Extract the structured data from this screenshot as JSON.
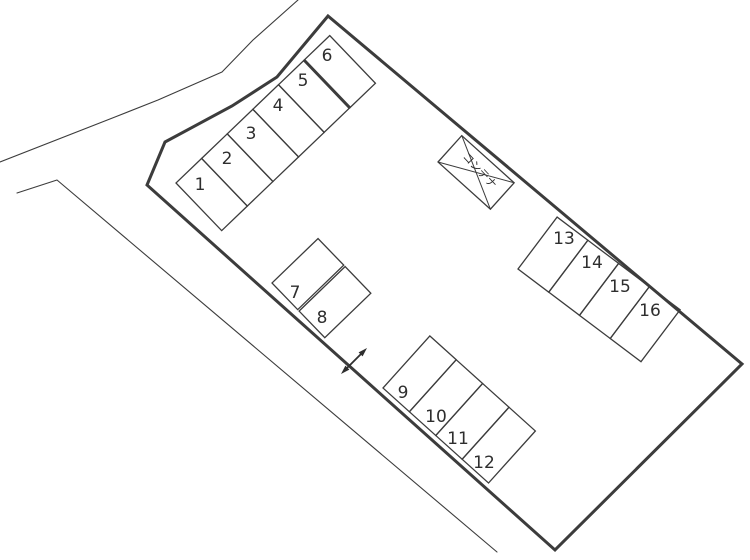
{
  "diagram": {
    "kind": "parking-lot-layout-plan",
    "background_color": "#ffffff",
    "line_color": "#3c3c3c",
    "space_count": 16,
    "spaces": [
      {
        "label": "1"
      },
      {
        "label": "2"
      },
      {
        "label": "3"
      },
      {
        "label": "4"
      },
      {
        "label": "5"
      },
      {
        "label": "6"
      },
      {
        "label": "7"
      },
      {
        "label": "8"
      },
      {
        "label": "9"
      },
      {
        "label": "10"
      },
      {
        "label": "11"
      },
      {
        "label": "12"
      },
      {
        "label": "13"
      },
      {
        "label": "14"
      },
      {
        "label": "15"
      },
      {
        "label": "16"
      }
    ],
    "container": {
      "label": "コンテナ"
    },
    "icons": {
      "two_way_arrow": "↔"
    }
  }
}
